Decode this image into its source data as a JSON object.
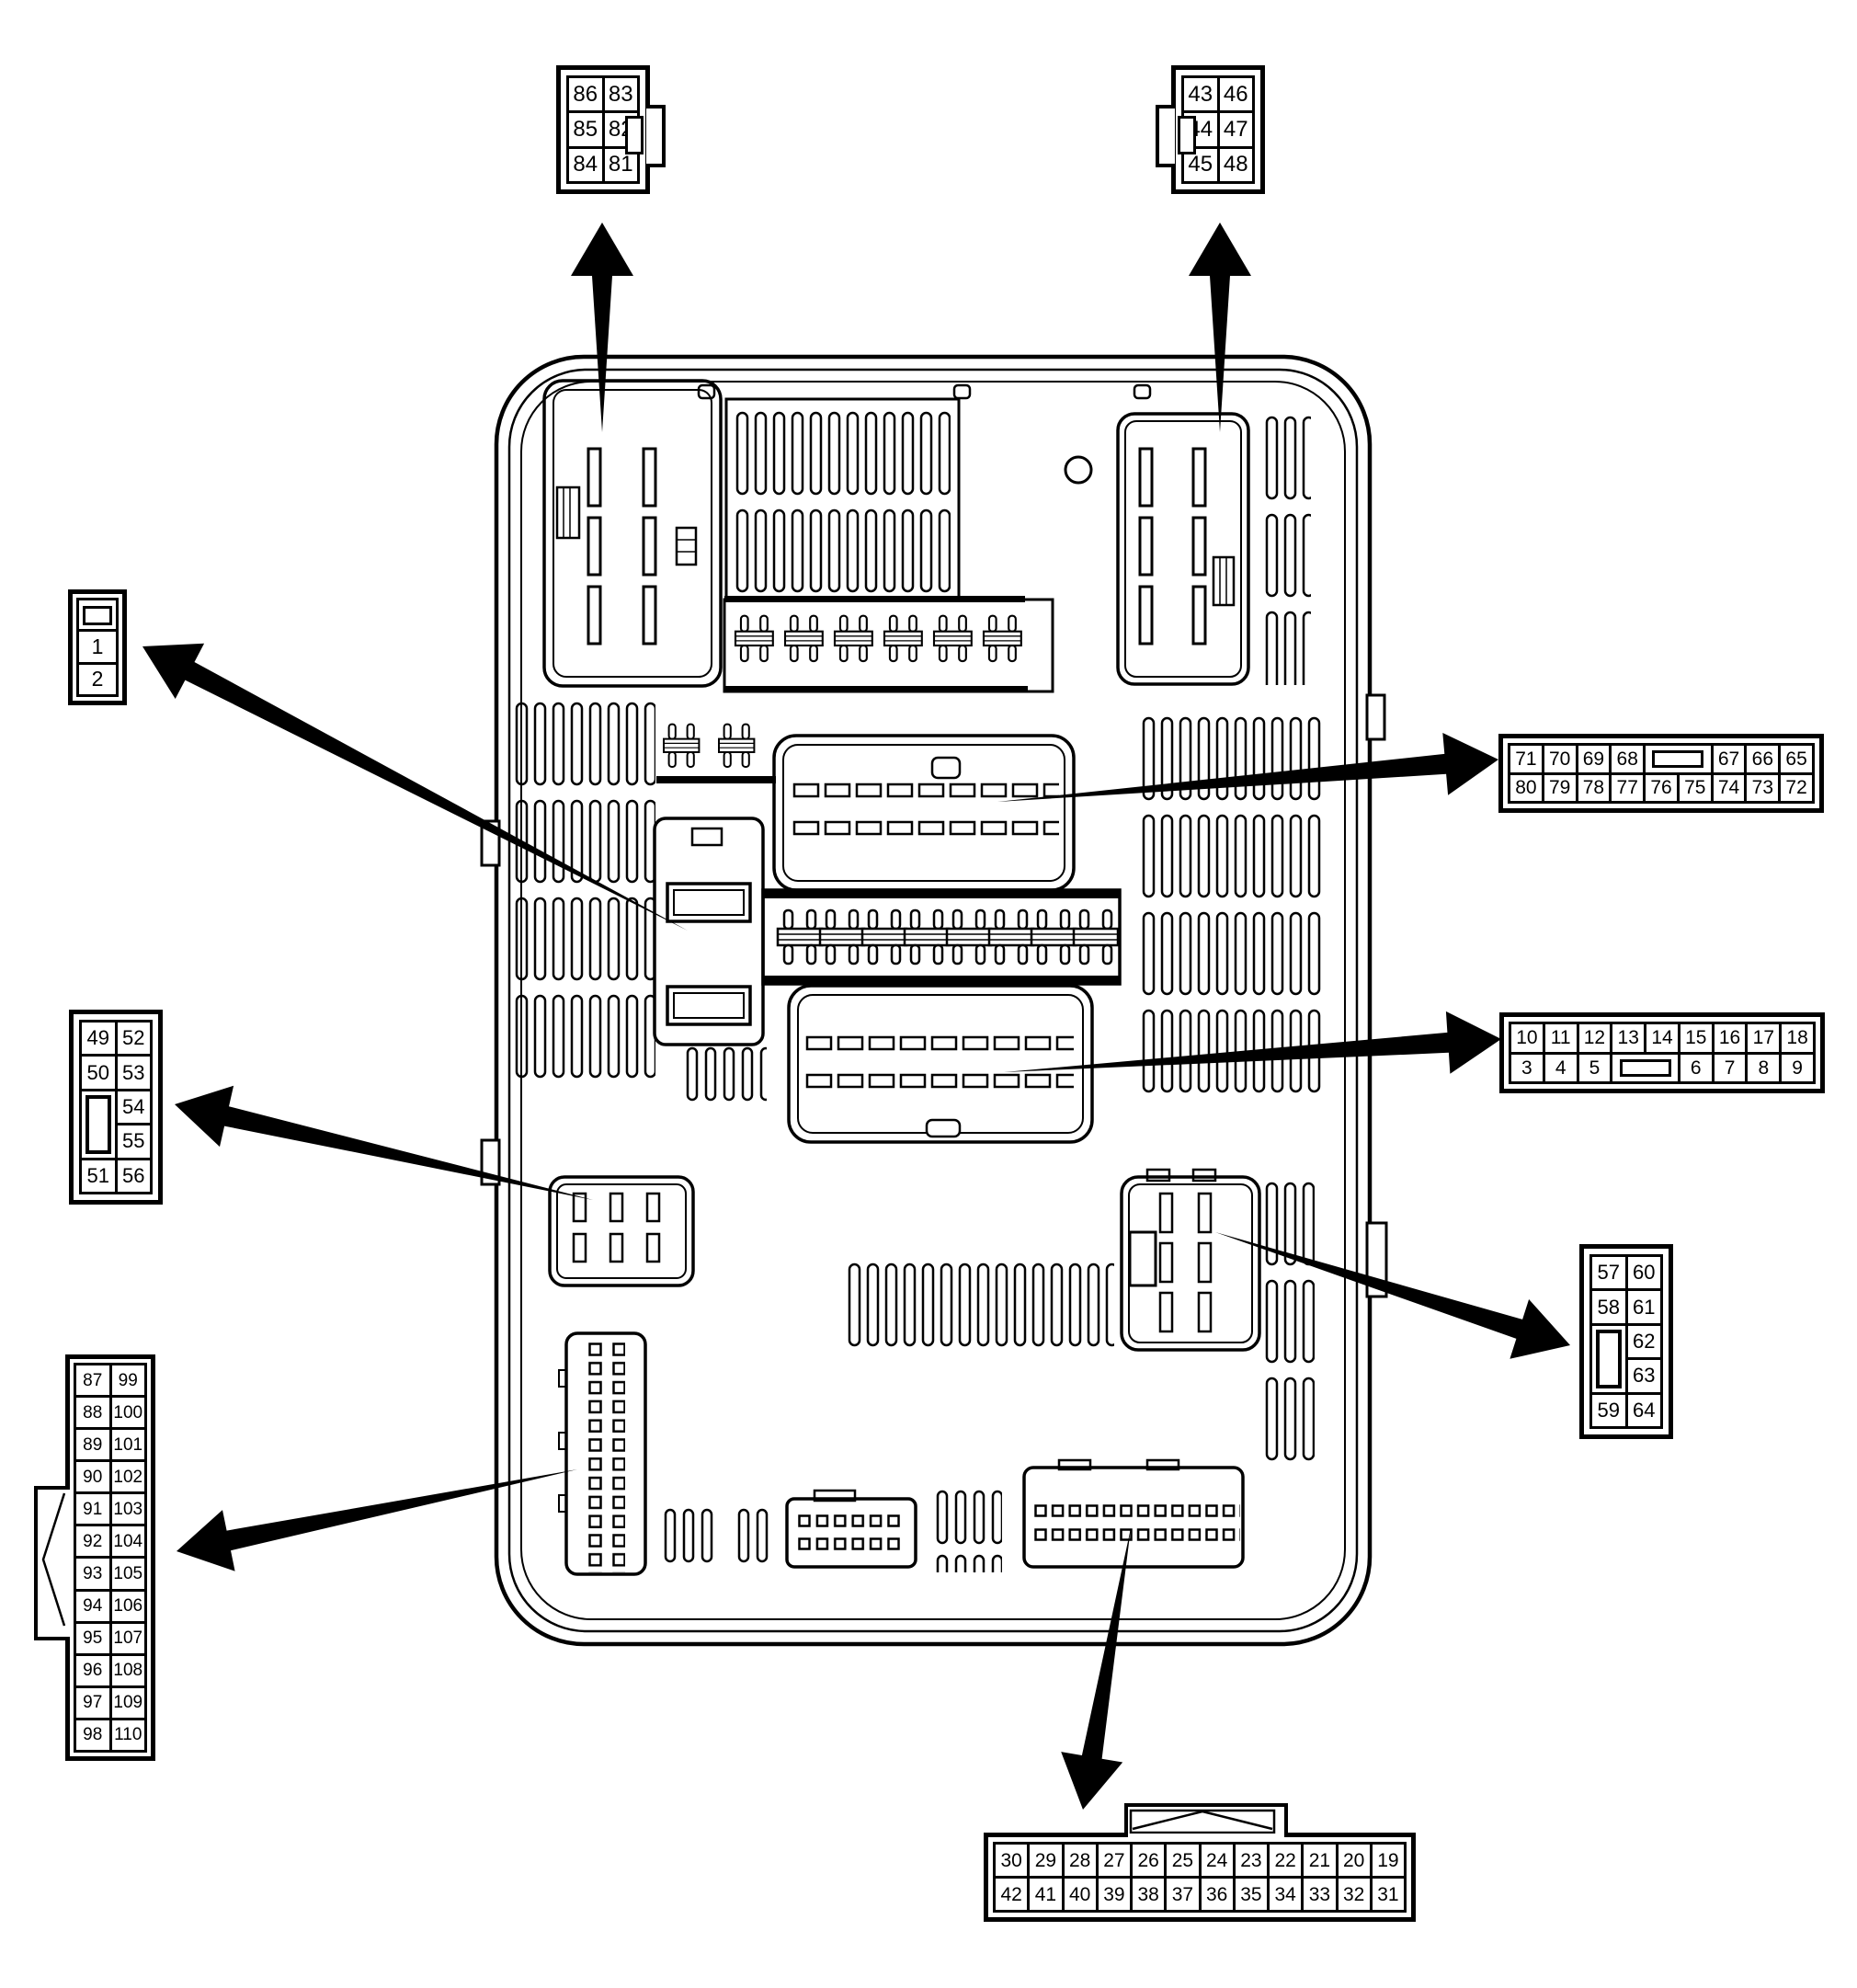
{
  "title": "Fuse block connector pin-out diagram",
  "colors": {
    "line": "#000000",
    "background": "#ffffff"
  },
  "connectors": {
    "c86": {
      "label": "connector-81-86",
      "rows": [
        [
          "86",
          "83"
        ],
        [
          "85",
          "82"
        ],
        [
          "84",
          "81"
        ]
      ]
    },
    "c43": {
      "label": "connector-43-48",
      "rows": [
        [
          "43",
          "46"
        ],
        [
          "44",
          "47"
        ],
        [
          "45",
          "48"
        ]
      ]
    },
    "c1": {
      "label": "connector-1-2",
      "pins": [
        "1",
        "2"
      ]
    },
    "c65": {
      "label": "connector-65-80",
      "rows": [
        [
          "71",
          "70",
          "69",
          "68",
          {
            "type": "slot-h",
            "cols": 2
          },
          "67",
          "66",
          "65"
        ],
        [
          "80",
          "79",
          "78",
          "77",
          "76",
          "75",
          "74",
          "73",
          "72"
        ]
      ]
    },
    "c3": {
      "label": "connector-3-18",
      "rows": [
        [
          "10",
          "11",
          "12",
          "13",
          "14",
          "15",
          "16",
          "17",
          "18"
        ],
        [
          "3",
          "4",
          "5",
          {
            "type": "slot-h",
            "cols": 2
          },
          "6",
          "7",
          "8",
          "9"
        ]
      ]
    },
    "c49": {
      "label": "connector-49-56",
      "rows": [
        [
          "49",
          "52"
        ],
        [
          "50",
          "53"
        ],
        [
          {
            "type": "slot-v",
            "rowspan": 2
          },
          "54"
        ],
        [
          null,
          "55"
        ],
        [
          "51",
          "56"
        ]
      ]
    },
    "c57": {
      "label": "connector-57-64",
      "rows": [
        [
          "57",
          "60"
        ],
        [
          "58",
          "61"
        ],
        [
          {
            "type": "slot-v",
            "rowspan": 2
          },
          "62"
        ],
        [
          null,
          "63"
        ],
        [
          "59",
          "64"
        ]
      ]
    },
    "c87": {
      "label": "connector-87-110",
      "rows": [
        [
          "87",
          "99"
        ],
        [
          "88",
          "100"
        ],
        [
          "89",
          "101"
        ],
        [
          "90",
          "102"
        ],
        [
          "91",
          "103"
        ],
        [
          "92",
          "104"
        ],
        [
          "93",
          "105"
        ],
        [
          "94",
          "106"
        ],
        [
          "95",
          "107"
        ],
        [
          "96",
          "108"
        ],
        [
          "97",
          "109"
        ],
        [
          "98",
          "110"
        ]
      ]
    },
    "c19": {
      "label": "connector-19-42",
      "rows": [
        [
          "30",
          "29",
          "28",
          "27",
          "26",
          "25",
          "24",
          "23",
          "22",
          "21",
          "20",
          "19"
        ],
        [
          "42",
          "41",
          "40",
          "39",
          "38",
          "37",
          "36",
          "35",
          "34",
          "33",
          "32",
          "31"
        ]
      ]
    }
  }
}
